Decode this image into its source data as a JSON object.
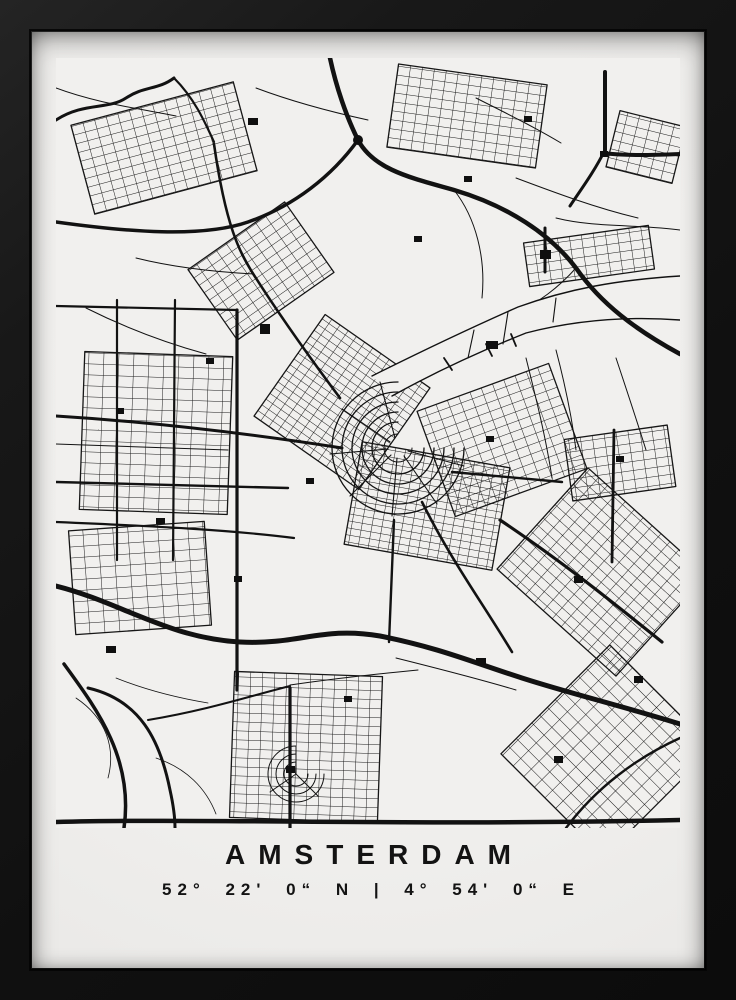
{
  "poster": {
    "title": "AMSTERDAM",
    "coordinates": "52° 22' 0“ N | 4° 54' 0“ E",
    "colors": {
      "ink": "#121212",
      "paper": "#f1f0ee",
      "frame": "#141414"
    }
  }
}
